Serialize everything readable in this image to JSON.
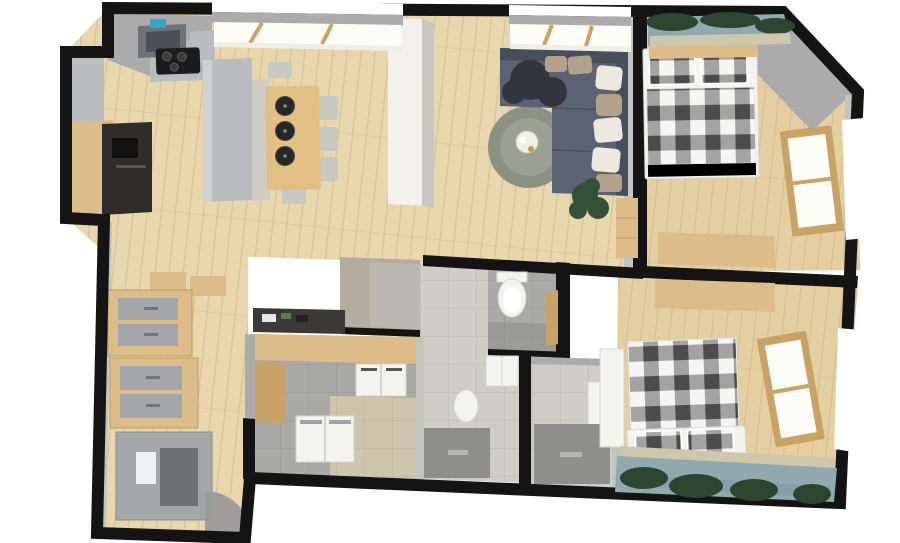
{
  "scene": {
    "type": "3d-floor-plan-render",
    "description": "Top-down 3D rendered floor plan of an apartment with open kitchen and living room, two bedrooms with black-and-white plaid beds, bathrooms, WC, laundry room and entry hallway",
    "view": "top-down, slightly rotated"
  },
  "colors": {
    "page": "#ffffff",
    "wall": "#141414",
    "wallFace": "#ababab",
    "wallFaceLight": "#c3c3c0",
    "floorWood": "#e8d6ac",
    "floorWoodBedroom": "#e4cfa0",
    "plankLine": "#c9ab7c",
    "woodFurniture": "#dcbd8a",
    "woodFrame": "#c9a265",
    "steel": "#b9bdbf",
    "counterDark": "#2e2d2b",
    "hood": "#6f7276",
    "teal": "#2fa9c4",
    "stone": "#cfcdc6",
    "tableWood": "#e2c083",
    "plate": "#282828",
    "chair": "#c9c9c4",
    "sofa": "#5a6273",
    "sofaDark": "#474e5c",
    "throw": "#33363e",
    "pillowWhite": "#ece8dd",
    "pillowTan": "#b2a28a",
    "rug": "#8c9184",
    "rugInner": "#9ba192",
    "plant": "#335138",
    "pot": "#7a6a52",
    "plaidDark": "#4c4c4c",
    "plaidMid": "#a3a3a3",
    "plaidWhite": "#f5f5f4",
    "bedFrame": "#f3f3f0",
    "tileLight": "#cfcdc7",
    "tileMid": "#a9a9a7",
    "tileBeige": "#cfc5ad",
    "tileDark": "#8e8e8c",
    "concrete": "#b2aca1",
    "fixtureWhite": "#f3f3f0",
    "paneWhite": "#fdfdf8",
    "sky": "#8fa9ae",
    "tree": "#2c4631",
    "water": "#7e9aa4",
    "building": "#cfc6ae",
    "doorSwing": "#9b9b9b",
    "mirror": "#eef2f2",
    "wardrobeGray": "#a4a7a9",
    "wardrobeDark": "#6e7173",
    "sideboardDark": "#3b3a38"
  },
  "rooms": [
    {
      "id": "kitchen",
      "name": "Kitchen",
      "furniture": [
        "range-hood",
        "cooktop",
        "tall-cabinet",
        "kitchen-counter",
        "kitchen-island",
        "stone-counter",
        "dining-table",
        "serving-plates",
        "dining-chairs"
      ]
    },
    {
      "id": "living-room",
      "name": "Living room",
      "furniture": [
        "corner-sofa",
        "throw-blanket",
        "cushions",
        "round-rug",
        "coffee-table",
        "potted-plant",
        "sideboard",
        "structural-column",
        "skylight-windows"
      ]
    },
    {
      "id": "bedroom-1",
      "name": "Bedroom 1",
      "furniture": [
        "double-bed-plaid",
        "plaid-pillows",
        "headboard-shelf",
        "desk",
        "side-window",
        "view-window"
      ]
    },
    {
      "id": "bedroom-2",
      "name": "Bedroom 2",
      "furniture": [
        "double-bed-plaid",
        "plaid-pillows",
        "desk",
        "white-wardrobe",
        "side-window",
        "panoramic-view-window"
      ]
    },
    {
      "id": "wc",
      "name": "WC",
      "furniture": [
        "toilet",
        "wooden-door"
      ]
    },
    {
      "id": "bathroom-1",
      "name": "Bathroom 1",
      "furniture": [
        "washbasin",
        "toilet",
        "shower"
      ]
    },
    {
      "id": "bathroom-2",
      "name": "Bathroom 2",
      "furniture": [
        "shower",
        "vanity"
      ]
    },
    {
      "id": "laundry",
      "name": "Laundry room",
      "furniture": [
        "washer-dryer-pair",
        "top-load-machines",
        "wood-panel"
      ]
    },
    {
      "id": "hallway",
      "name": "Entry hallway",
      "furniture": [
        "wardrobe-cabinet-upper",
        "wardrobe-cabinet-lower",
        "mirror-wardrobe",
        "console-table",
        "entry-door-swing"
      ]
    }
  ]
}
